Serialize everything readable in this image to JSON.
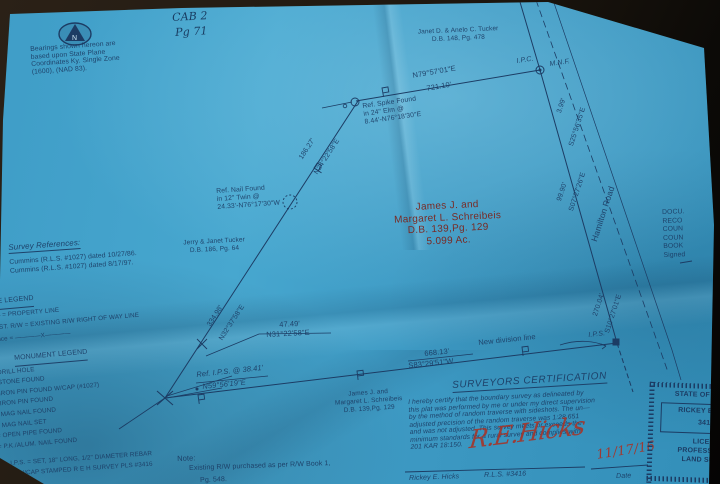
{
  "colors": {
    "paper": "#3f9dc7",
    "ink": "#1c3c64",
    "red_text": "#7c241c",
    "signature_red": "#a5352a"
  },
  "handwritten": {
    "cab": "CAB 2",
    "pg": "Pg 71",
    "date": "11/17/16"
  },
  "bearings_note": {
    "lines": [
      "Bearings shown hereon are",
      "based upon State Plane",
      "Coordinates Ky. Single Zone",
      "(1600), (NAD 83)."
    ]
  },
  "neighbors": {
    "north": {
      "lines": [
        "Janet D. & Anelo C. Tucker",
        "D.B. 148, Pg. 478"
      ]
    },
    "west": {
      "lines": [
        "Jerry & Janet Tucker",
        "D.B. 186, Pg. 64"
      ]
    },
    "south": {
      "lines": [
        "James J. and",
        "Margaret L. Schreibeis",
        "D.B. 139,Pg. 129"
      ]
    }
  },
  "subject_parcel": {
    "lines": [
      "James J. and",
      "Margaret L. Schreibeis",
      "D.B. 139,Pg. 129",
      "5.099 Ac."
    ]
  },
  "boundary_labels": {
    "north_line": {
      "bearing": "N79°57'01\"E",
      "distance": "721.10'"
    },
    "diag_upper": {
      "bearing": "N24°22'58\"E",
      "distance": "186.27'"
    },
    "diag_lower": {
      "bearing": "N32°37'58\"E",
      "distance": "334.98'"
    },
    "tie": {
      "bearing": "N31°22'58\"E",
      "distance": "47.49'"
    },
    "south_line": {
      "bearing": "S83°29'51\"W",
      "distance": "668.13'",
      "note": "New division line"
    },
    "ref_spike": {
      "lines": [
        "Ref. Spike Found",
        "in 24\" Elm @",
        "8.44'-N76°18'30\"E"
      ]
    },
    "ref_nail": {
      "lines": [
        "Ref. Nail Found",
        "in 12\" Twin @",
        "24.33'-N76°17'30\"W"
      ]
    },
    "ref_ips": {
      "lines": [
        "Ref. I.P.S. @ 38.41'",
        "N59°56'19\"E"
      ]
    }
  },
  "markers": {
    "ipc": "I.P.C.",
    "mnf": "M.N.F.",
    "ips": "I.P.S."
  },
  "road": {
    "name": "Hamilton Road",
    "segments": [
      {
        "bearing": "S25°56'35\"E",
        "distance": "3.99'"
      },
      {
        "bearing": "S07°27'26\"E",
        "distance": "99.90'"
      },
      {
        "bearing": "S10°27'01\"E",
        "distance": "270.04'"
      }
    ]
  },
  "survey_references": {
    "title": "Survey References:",
    "items": [
      "Cummins (R.L.S. #1027) dated 10/27/86.",
      "Cummins (R.L.S. #1027) dated 8/17/97."
    ]
  },
  "line_legend": {
    "title": "LINE LEGEND",
    "items": [
      "—— = PROPERTY LINE",
      "EXIST. R/W = EXISTING R/W RIGHT OF WAY LINE",
      "Fence = ————X————"
    ]
  },
  "monument_legend": {
    "title": "MONUMENT LEGEND",
    "items": [
      "= DRILL HOLE",
      "= STONE FOUND",
      "= IRON PIN FOUND W/CAP (#1027)",
      "= IRON PIN FOUND",
      "= MAG NAIL FOUND",
      "= MAG NAIL SET",
      "= OPEN PIPE FOUND",
      "= P.K./ALUM. NAIL FOUND"
    ],
    "ips_note": [
      "I.P.S. = SET, 18\" LONG, 1/2\" DIAMETER REBAR",
      "W/CAP STAMPED R E H SURVEY PLS #3416"
    ]
  },
  "note": {
    "title": "Note:",
    "lines": [
      "Existing R/W purchased as per R/W Book 1,",
      "Pg. 548."
    ]
  },
  "certification": {
    "title": "SURVEYORS CERTIFICATION",
    "body": [
      "I hereby certify that the boundary survey as delineated by",
      "this plat was performed by me or under my direct supervision",
      "by the method of random traverse with sideshots. The un—",
      "adjusted precision of the random traverse was 1:28,651",
      "and was not adjusted. This survey meets or exceeds the",
      "minimum standards for a rural survey and complies with",
      "201 KAR 18:150."
    ],
    "signature": "R.E.Hicks",
    "signer": "Rickey E. Hicks",
    "license": "R.L.S. #3416",
    "date_label": "Date"
  },
  "stamps": {
    "recorder": {
      "lines": [
        "DOCU.",
        "RECO",
        "COUN",
        "COUN",
        "BOOK",
        "Signed"
      ]
    },
    "seal": {
      "state": "STATE OF K",
      "name": "RICKEY E.",
      "number": "3416",
      "lines": [
        "LICEN",
        "PROFESSI",
        "LAND SU"
      ]
    }
  }
}
